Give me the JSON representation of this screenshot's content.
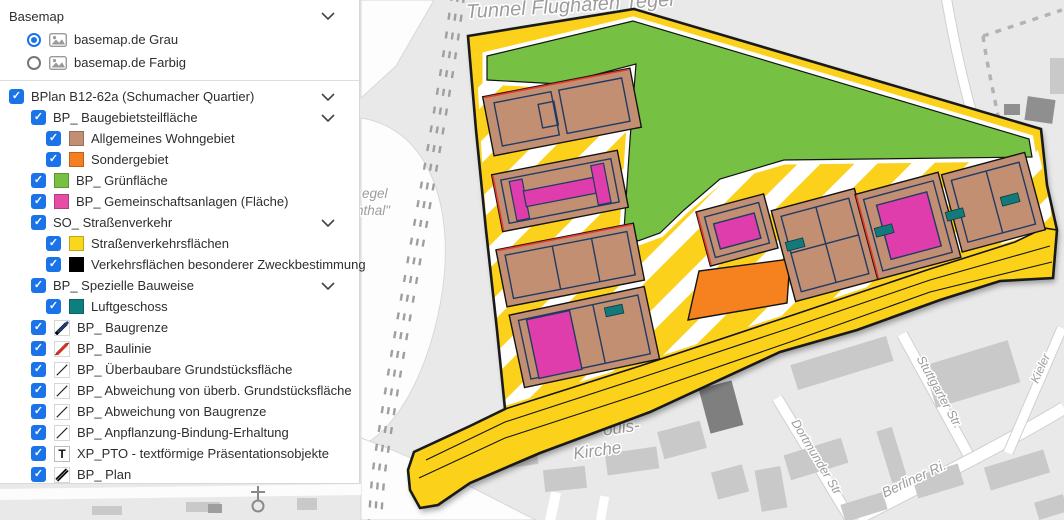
{
  "panel": {
    "basemap": {
      "title": "Basemap",
      "options": [
        {
          "label": "basemap.de Grau",
          "selected": true
        },
        {
          "label": "basemap.de Farbig",
          "selected": false
        }
      ]
    },
    "layers": [
      {
        "label": "BPlan B12-62a (Schumacher Quartier)",
        "indent": 1,
        "symbol": "none",
        "chevron": true
      },
      {
        "label": "BP_ Baugebietsteilfläche",
        "indent": 2,
        "symbol": "none",
        "chevron": true
      },
      {
        "label": "Allgemeines Wohngebiet",
        "indent": 3,
        "symbol": "fill",
        "color": "#C28F73"
      },
      {
        "label": "Sondergebiet",
        "indent": 3,
        "symbol": "fill",
        "color": "#F47E20"
      },
      {
        "label": "BP_ Grünfläche",
        "indent": 2,
        "symbol": "fill",
        "color": "#76C043"
      },
      {
        "label": "BP_ Gemeinschaftsanlagen (Fläche)",
        "indent": 2,
        "symbol": "fill",
        "color": "#E64CA5"
      },
      {
        "label": "SO_ Straßenverkehr",
        "indent": 2,
        "symbol": "none",
        "chevron": true
      },
      {
        "label": "Straßenverkehrsflächen",
        "indent": 3,
        "symbol": "fill",
        "color": "#F9D71C"
      },
      {
        "label": "Verkehrsflächen besonderer Zweckbestimmung",
        "indent": 3,
        "symbol": "fill",
        "color": "#000000"
      },
      {
        "label": "BP_ Spezielle Bauweise",
        "indent": 2,
        "symbol": "none",
        "chevron": true
      },
      {
        "label": "Luftgeschoss",
        "indent": 3,
        "symbol": "fill",
        "color": "#0E7F7F"
      },
      {
        "label": "BP_ Baugrenze",
        "indent": 2,
        "symbol": "line-baugrenze"
      },
      {
        "label": "BP_ Baulinie",
        "indent": 2,
        "symbol": "line-baulinie"
      },
      {
        "label": "BP_ Überbaubare Grundstücksfläche",
        "indent": 2,
        "symbol": "line-thin"
      },
      {
        "label": "BP_ Abweichung von überb. Grundstücksfläche",
        "indent": 2,
        "symbol": "line-thin"
      },
      {
        "label": "BP_ Abweichung von Baugrenze",
        "indent": 2,
        "symbol": "line-thin"
      },
      {
        "label": "BP_ Anpflanzung-Bindung-Erhaltung",
        "indent": 2,
        "symbol": "line-thin"
      },
      {
        "label": "XP_PTO - textförmige Präsentationsobjekte",
        "indent": 2,
        "symbol": "text-T"
      },
      {
        "label": "BP_ Plan",
        "indent": 2,
        "symbol": "line-plan"
      }
    ]
  },
  "map": {
    "labels": {
      "airport_top": "Tunnel Flughafen Tegel",
      "fragment_line1": "egel",
      "fragment_line2": "nthal\"",
      "church_line1": "ouis-",
      "church_line2": "Kirche",
      "street_stuttgarter": "Stuttgarter Str.",
      "street_dortmunder": "Dortmunder Str",
      "street_berliner": "Berliner Ri.",
      "street_kieler": "Kieler"
    },
    "colors": {
      "residential": "#C28F73",
      "special": "#F5821F",
      "green": "#76C043",
      "community": "#DF3CAC",
      "street": "#FBD11A",
      "air_floor": "#14797B"
    }
  }
}
